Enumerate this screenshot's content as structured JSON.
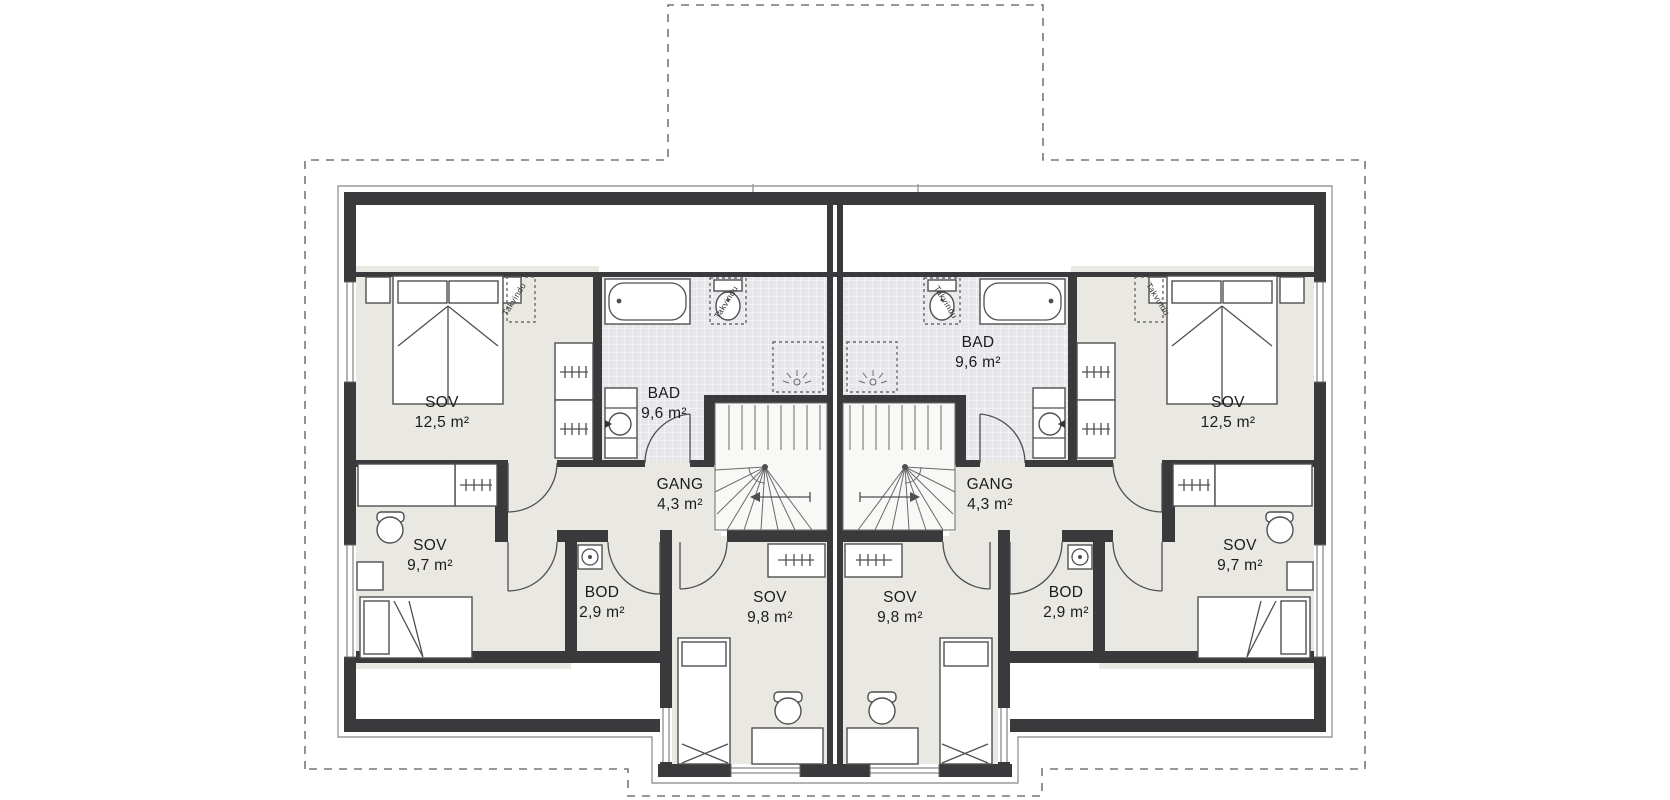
{
  "page": {
    "type": "architectural-floor-plan",
    "background": "#ffffff"
  },
  "colors": {
    "wall": "#3a393b",
    "room_floor": "#eae8e2",
    "bath_tile": "#e6e6eb",
    "outline": "#4f4f4f",
    "roofline_dash": "#777777"
  },
  "annotations": {
    "roof_window": "Takvindu"
  },
  "rooms": {
    "sov_large_left": {
      "name": "SOV",
      "area": "12,5 m²"
    },
    "bad_left": {
      "name": "BAD",
      "area": "9,6 m²"
    },
    "gang_left": {
      "name": "GANG",
      "area": "4,3 m²"
    },
    "sov_small_left": {
      "name": "SOV",
      "area": "9,7 m²"
    },
    "bod_left": {
      "name": "BOD",
      "area": "2,9 m²"
    },
    "sov_mid_left": {
      "name": "SOV",
      "area": "9,8 m²"
    },
    "sov_large_right": {
      "name": "SOV",
      "area": "12,5 m²"
    },
    "bad_right": {
      "name": "BAD",
      "area": "9,6 m²"
    },
    "gang_right": {
      "name": "GANG",
      "area": "4,3 m²"
    },
    "sov_small_right": {
      "name": "SOV",
      "area": "9,7 m²"
    },
    "bod_right": {
      "name": "BOD",
      "area": "2,9 m²"
    },
    "sov_mid_right": {
      "name": "SOV",
      "area": "9,8 m²"
    }
  },
  "symbols": [
    "double-bed",
    "single-bed",
    "bathtub",
    "toilet",
    "washbasin",
    "wardrobe",
    "desk",
    "office-chair",
    "winder-staircase",
    "ventilation-unit",
    "ceiling-spotlight",
    "roof-window",
    "window",
    "door-swing"
  ]
}
